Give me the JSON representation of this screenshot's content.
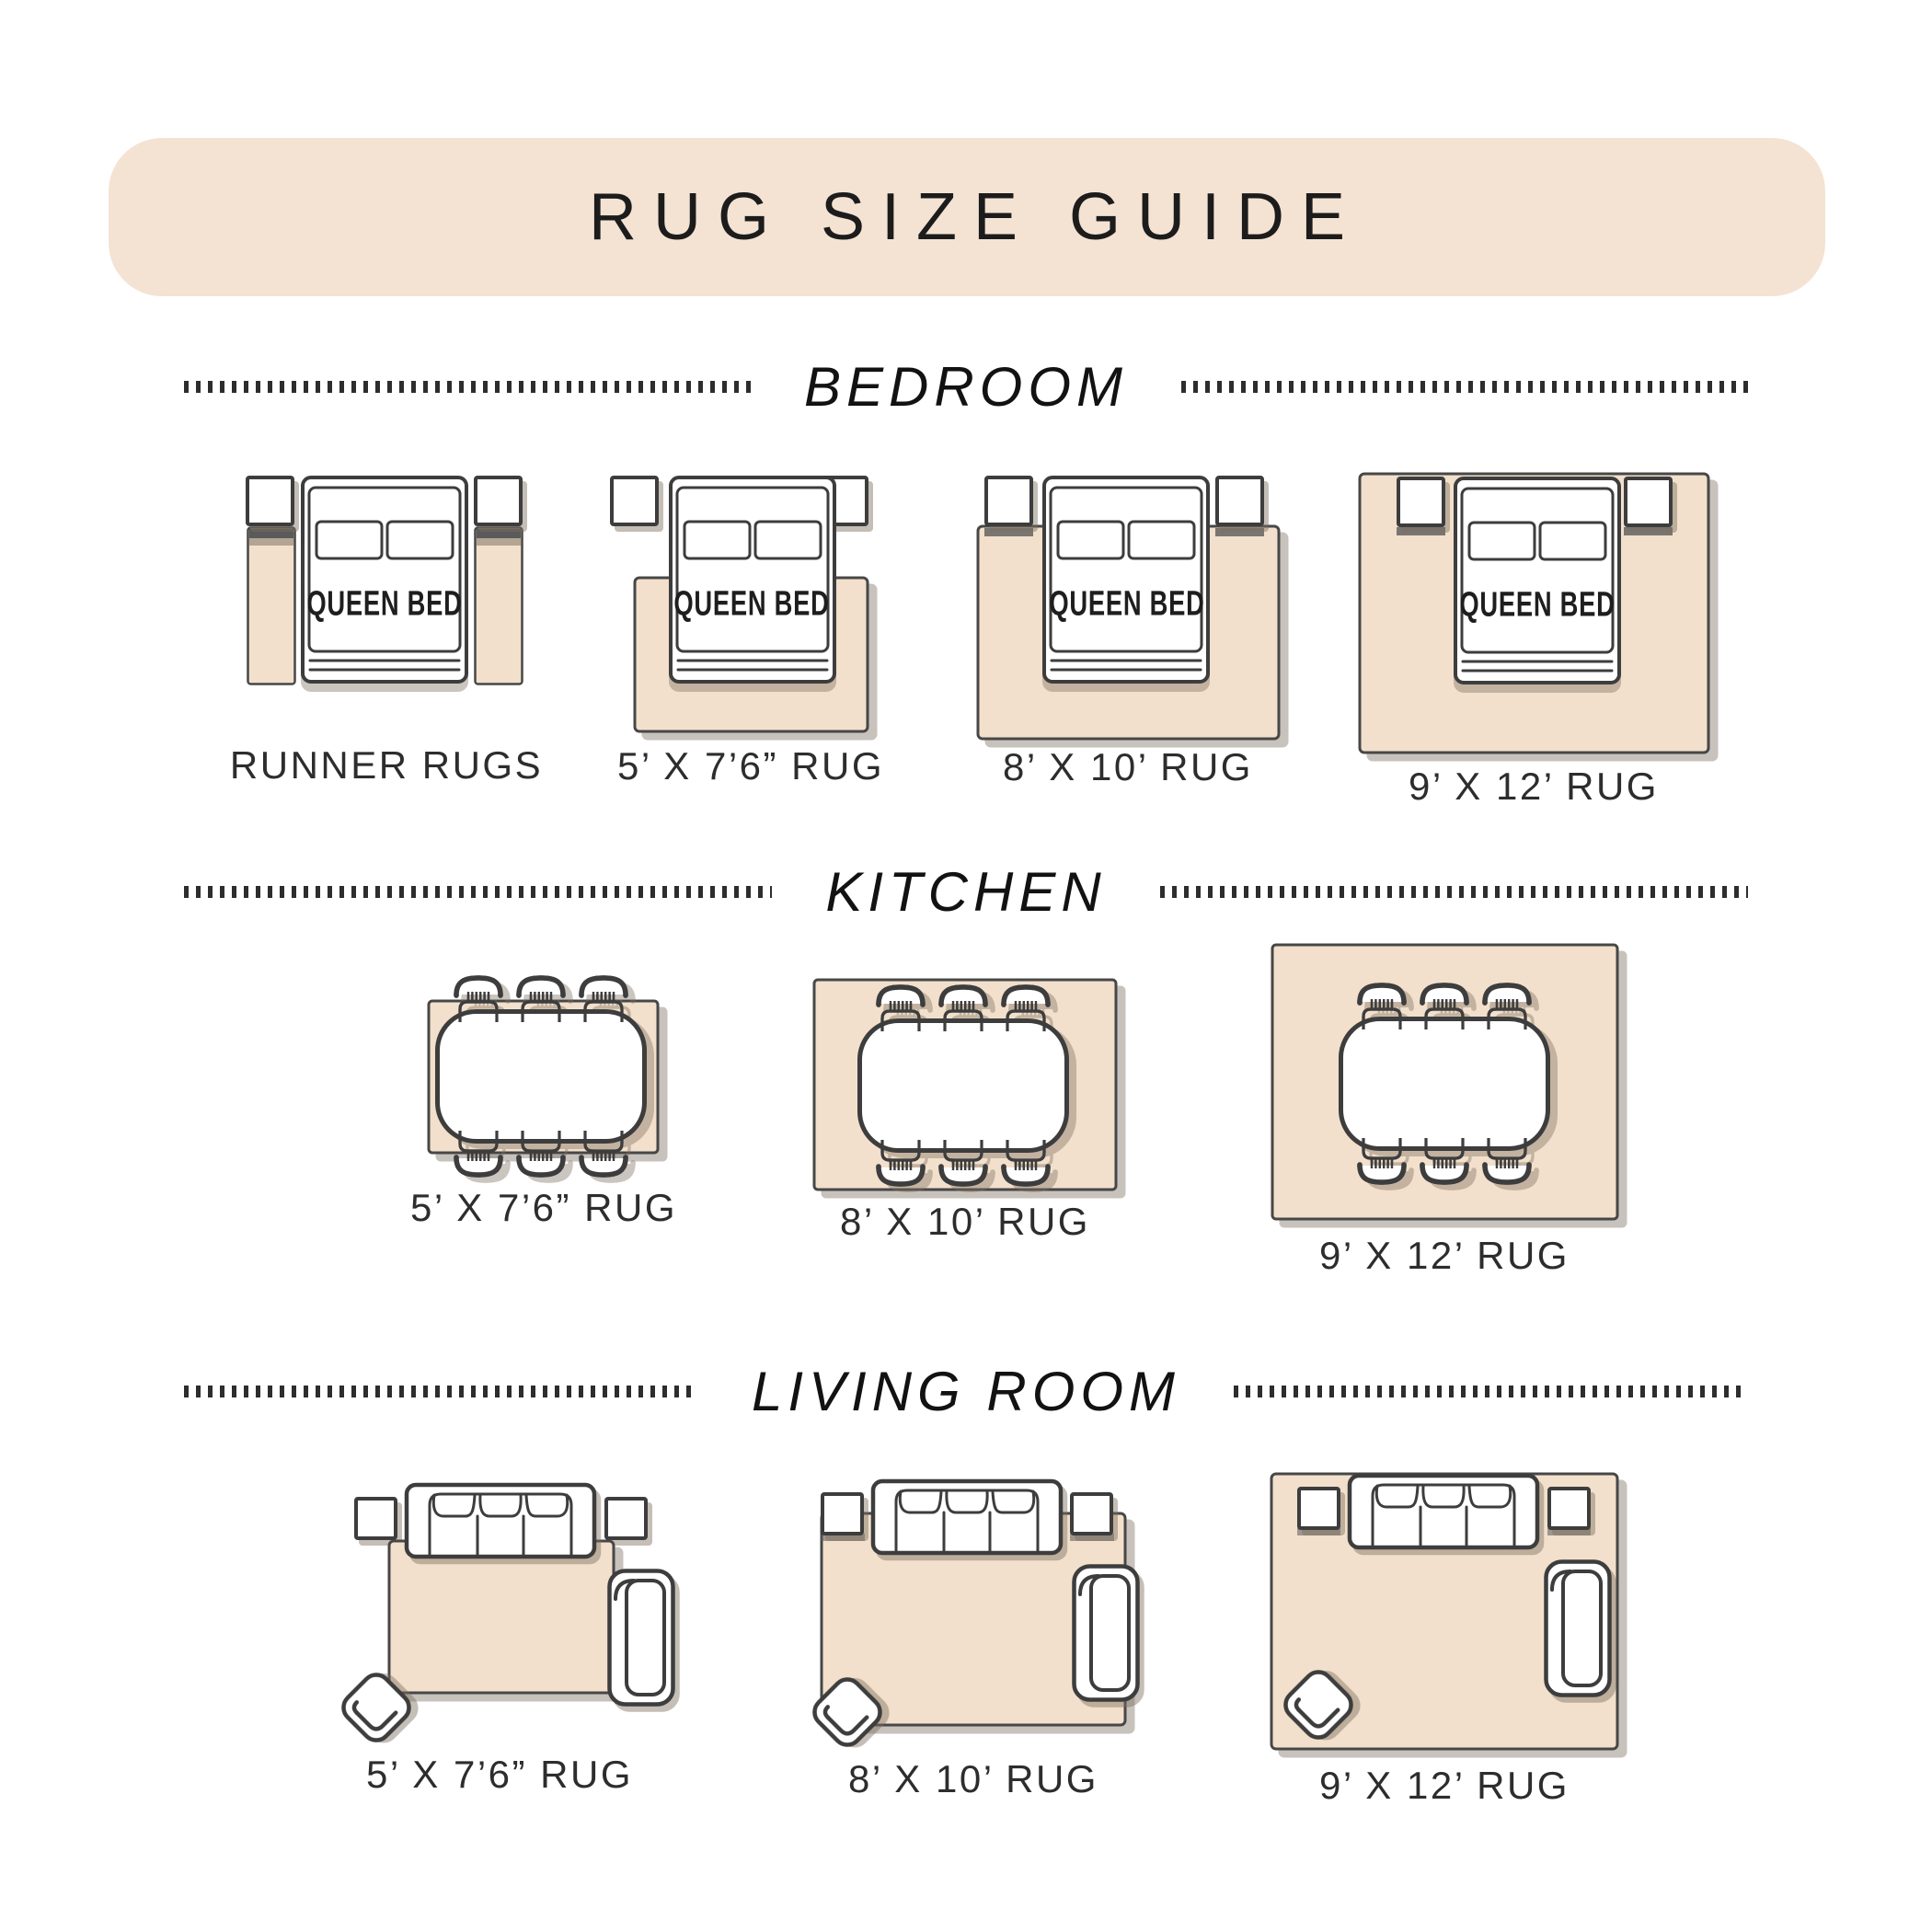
{
  "title": "RUG SIZE GUIDE",
  "bed_label": "QUEEN BED",
  "colors": {
    "banner": "#f4e3d3",
    "rug": "#f2e0cc",
    "outline": "#3d3d3d",
    "text": "#1c1c1c"
  },
  "sections": [
    {
      "label": "BEDROOM",
      "items": [
        {
          "label": "RUNNER RUGS"
        },
        {
          "label": "5’ X 7’6” RUG"
        },
        {
          "label": "8’ X 10’ RUG"
        },
        {
          "label": "9’ X 12’ RUG"
        }
      ]
    },
    {
      "label": "KITCHEN",
      "items": [
        {
          "label": "5’ X 7’6” RUG"
        },
        {
          "label": "8’ X 10’ RUG"
        },
        {
          "label": "9’ X 12’ RUG"
        }
      ]
    },
    {
      "label": "LIVING ROOM",
      "items": [
        {
          "label": "5’ X 7’6” RUG"
        },
        {
          "label": "8’ X 10’ RUG"
        },
        {
          "label": "9’ X 12’ RUG"
        }
      ]
    }
  ]
}
